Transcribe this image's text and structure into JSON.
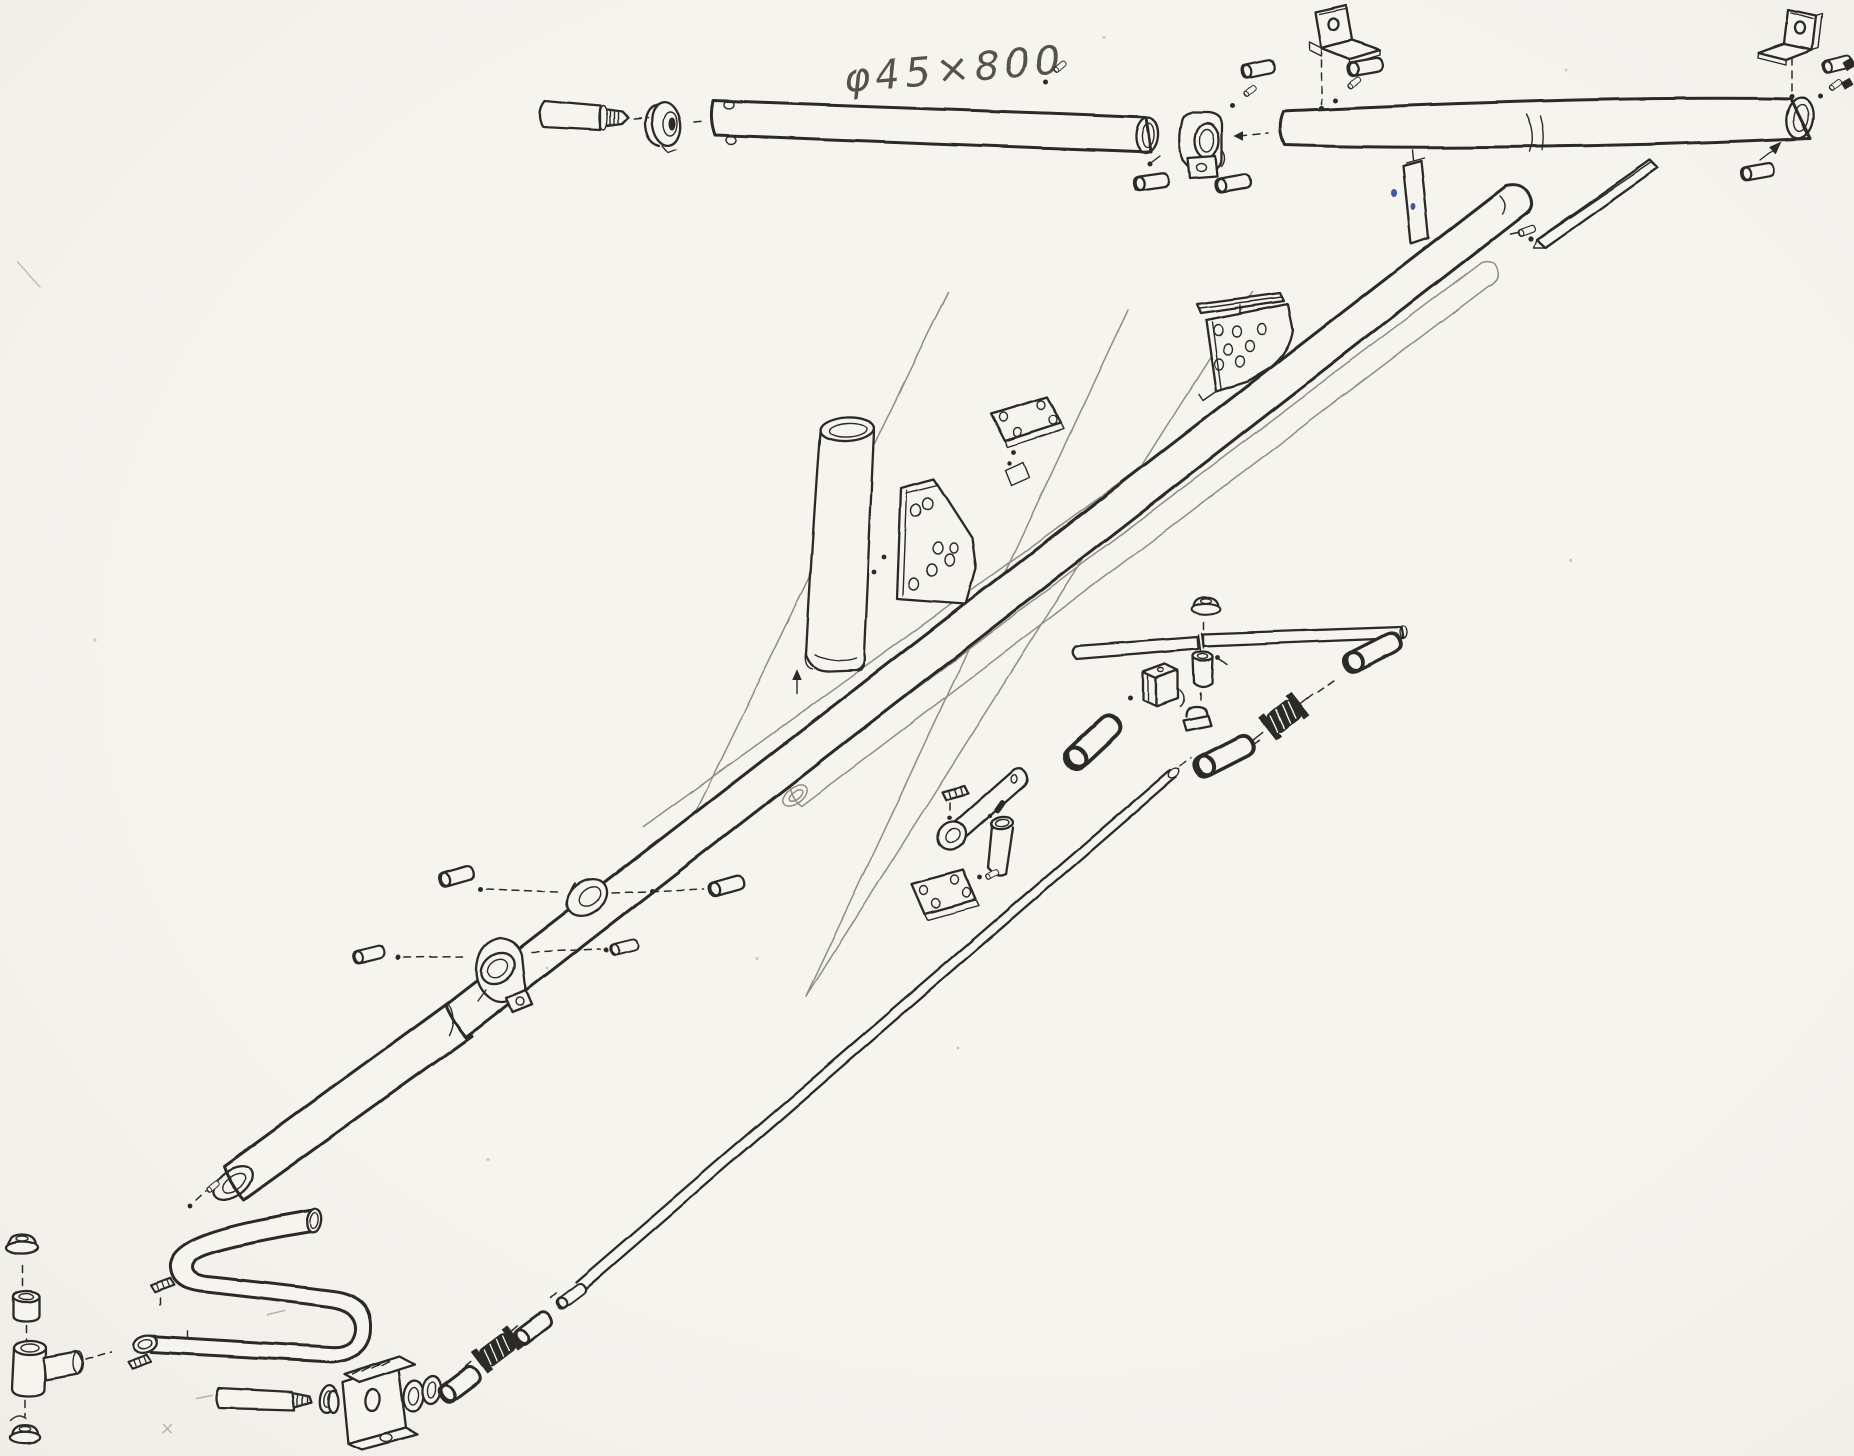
{
  "annotation": {
    "dimension_label": "φ45×800"
  },
  "colors": {
    "paper": "#f6f4ef",
    "ink": "#2b2a27",
    "pencil": "#8f8d86",
    "blue": "#4156a8"
  },
  "parts": [
    {
      "name": "dimension-annotation",
      "desc": "handwritten dimension phi 45 by 800"
    },
    {
      "name": "end-plug-tube",
      "desc": "short end tube with threaded stud"
    },
    {
      "name": "flanged-collar",
      "desc": "grooved collar flange"
    },
    {
      "name": "upper-tube-left",
      "desc": "long upper tube with rivet holes"
    },
    {
      "name": "saddle-clamp-upper",
      "desc": "tube clamp block with ear"
    },
    {
      "name": "upper-tube-right",
      "desc": "long upper tube phi45x800 with sleeve joint"
    },
    {
      "name": "angle-bracket-upper",
      "desc": "L mounting bracket with hole"
    },
    {
      "name": "angle-bracket-corner",
      "desc": "corner L mounting bracket"
    },
    {
      "name": "flat-bar-small",
      "desc": "small flat strip"
    },
    {
      "name": "channel-bar",
      "desc": "angle channel bar with screw"
    },
    {
      "name": "main-diagonal-tube",
      "desc": "main boom tube with sleeve joint"
    },
    {
      "name": "light-diagonal-tube",
      "desc": "inner boom tube drawn in pencil"
    },
    {
      "name": "slide-collar",
      "desc": "collar ring on boom with side pins"
    },
    {
      "name": "saddle-clamp-lower",
      "desc": "C clamp on boom with side pins"
    },
    {
      "name": "vertical-post-tube",
      "desc": "oval section post tube"
    },
    {
      "name": "gusset-plate",
      "desc": "gusset plate with seven holes"
    },
    {
      "name": "four-hole-plate-upper",
      "desc": "small rectangular plate four holes"
    },
    {
      "name": "perforated-bracket",
      "desc": "perforated wedge plate with flat strip"
    },
    {
      "name": "cross-rod",
      "desc": "thin cross rod"
    },
    {
      "name": "cap-nut-top",
      "desc": "cap nut above cross rod"
    },
    {
      "name": "guide-sleeve",
      "desc": "sleeve bushing"
    },
    {
      "name": "u-bracket",
      "desc": "small channel bracket"
    },
    {
      "name": "cap-nut-mid",
      "desc": "cap nut on square base"
    },
    {
      "name": "turnbuckle-mid",
      "desc": "knurled adjuster with stub shafts"
    },
    {
      "name": "stub-tube-left",
      "desc": "angled stub tube"
    },
    {
      "name": "stub-tube-lower",
      "desc": "stub tube below adjuster"
    },
    {
      "name": "stub-tube-right",
      "desc": "angled stub tube at rod end"
    },
    {
      "name": "drilled-stub-tube",
      "desc": "stub tube with holes and end ring"
    },
    {
      "name": "chamfered-cup",
      "desc": "beveled cup sleeve"
    },
    {
      "name": "four-hole-plate-lower",
      "desc": "rectangular plate four holes"
    },
    {
      "name": "serrated-clips",
      "desc": "small ribbed clips"
    },
    {
      "name": "tie-rod",
      "desc": "long thin tie rod"
    },
    {
      "name": "bent-hook-tube",
      "desc": "U-bent handle tube"
    },
    {
      "name": "elbow-fitting",
      "desc": "elbow socket fitting"
    },
    {
      "name": "cap-nut-stack",
      "desc": "cap nuts and bushing column"
    },
    {
      "name": "threaded-rod",
      "desc": "rod with threaded tip"
    },
    {
      "name": "washer",
      "desc": "washer ring"
    },
    {
      "name": "clevis-bracket",
      "desc": "clevis bracket with rollers"
    },
    {
      "name": "turnbuckle-lower",
      "desc": "knurled adjuster in tie rod chain"
    },
    {
      "name": "pin-spacers",
      "desc": "pin and spacer cylinders with dashed leaders"
    },
    {
      "name": "leader-lines",
      "desc": "light pencil leader and construction lines"
    }
  ]
}
